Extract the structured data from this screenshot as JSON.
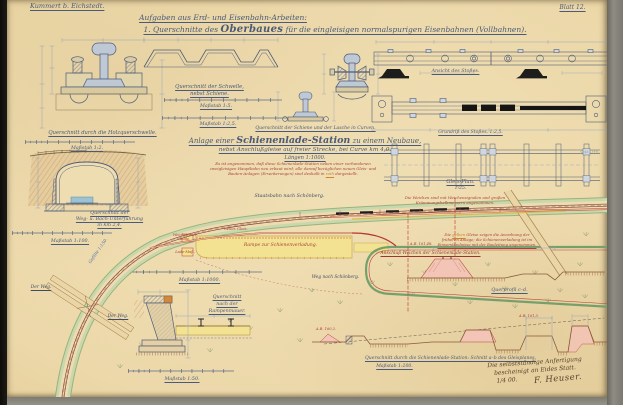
{
  "header": {
    "author": "Kummert b. Eichstedt.",
    "sheet": "Blatt 12."
  },
  "title": {
    "line1": "Aufgaben aus Erd- und Eisenbahn-Arbeiten:",
    "line2_pre": "1. Querschnitte des ",
    "line2_emph": "Oberbaues",
    "line2_post": " für die eingleisigen normalspurigen Eisenbahnen (Vollbahnen)."
  },
  "rail": {
    "cap_chair": "Querschnitt durch die Holzquerschwelle.",
    "scale_chair": "Maßstab 1:2.",
    "cap_sleeper_1": "Querschnitt der Schwelle,",
    "cap_sleeper_2": "nebst Schiene.",
    "scale_1_5": "Maßstab 1:5.",
    "scale_1_2_5": "Maßstab 1:2,5.",
    "cap_curve": "Querschnitt der Schiene und der Lasche in Curven.",
    "cap_joint_view": "Ansicht des Stoßes.",
    "cap_joint_plan": "Grundriß des Stoßes. 1:2,5.",
    "cap_track_plan_1": "Gleis-Plan.",
    "cap_track_plan_2": "1:25.",
    "note_switches_1": "Die Weichen sind mit Weichensignalen und großen",
    "note_switches_2": "Krümmungshalbmessern angenommen."
  },
  "tunnel": {
    "cap_1": "Querschnitt der",
    "cap_2": "Weg- u. Bach-Unterführung",
    "cap_3": "in km 2,4.",
    "scale": "Maßstab 1:100."
  },
  "station": {
    "heading_pre": "Anlage einer ",
    "heading_emph": "Schienenlade-Station",
    "heading_post": " zu einem Neubaue,",
    "heading_2": "nebst Anschlußgleise auf freier Strecke, bei Curve km 4,0.",
    "heading_3": "Längen 1:1000.",
    "note_1": "Es ist angenommen, daß diese Schienenlade-Station neben einer vorhandenen",
    "note_2": "zweigleisigen Hauptbahn neu erbaut wird; alle darauf bezüglichen neuen Gleis- und",
    "note_3_pre": "Bauten-Anlagen (Erweiterungen) sind deshalb in ",
    "note_3_word": "roth",
    "note_3_post": " dargestellt.",
    "scale_plan": "Maßstab 1:1000."
  },
  "plan": {
    "mainline": "Staatsbahn nach Schönberg.",
    "way_right": "Weg nach Schönberg.",
    "gradient": "Gefälle 1:150.",
    "road_left": "Der Weg.",
    "road_right": "Der Weg.",
    "ramp": "Rampe zur Schienenverladung.",
    "hut_1": "Weichenstell-",
    "hut_2": "Bude.",
    "gauge": "Lade-Maß.",
    "new_track": "neues Gleis.",
    "junction": "Anschluß-Weichen der Schienenlade-Station.",
    "yellow_1_pre": "Die ",
    "yellow_1_word": "gelben",
    "yellow_1_post": " Gleise zeigen die Anordnung der",
    "yellow_2": "früheren Anlage; die Schienenverladung ist im",
    "yellow_3": "Einverständnisse mit der Bauleitung angenommen."
  },
  "wall": {
    "cap_1": "Querschnitt",
    "cap_2": "nach der",
    "cap_3": "Rampenmauer.",
    "scale": "Maßstab 1:50."
  },
  "profiles": {
    "cap_cd": "Querprofil c–d.",
    "elev_1": "A.B. 161,48.",
    "elev_2": "A.B. 160,2.",
    "elev_3": "A.B. 161,5.",
    "cap_ab": "Querschnitt durch die Schienenlade-Station: Schnitt a–b des Gleisplanes.",
    "scale_ab": "Maßstab 1:200."
  },
  "signature": {
    "line1": "Die selbstständige Anfertigung",
    "line2": "bescheinigt an Eides Statt.",
    "line3": "1/4 00.",
    "name": "F. Heuser."
  },
  "margin": {
    "pencil": "Sekt. 146."
  }
}
